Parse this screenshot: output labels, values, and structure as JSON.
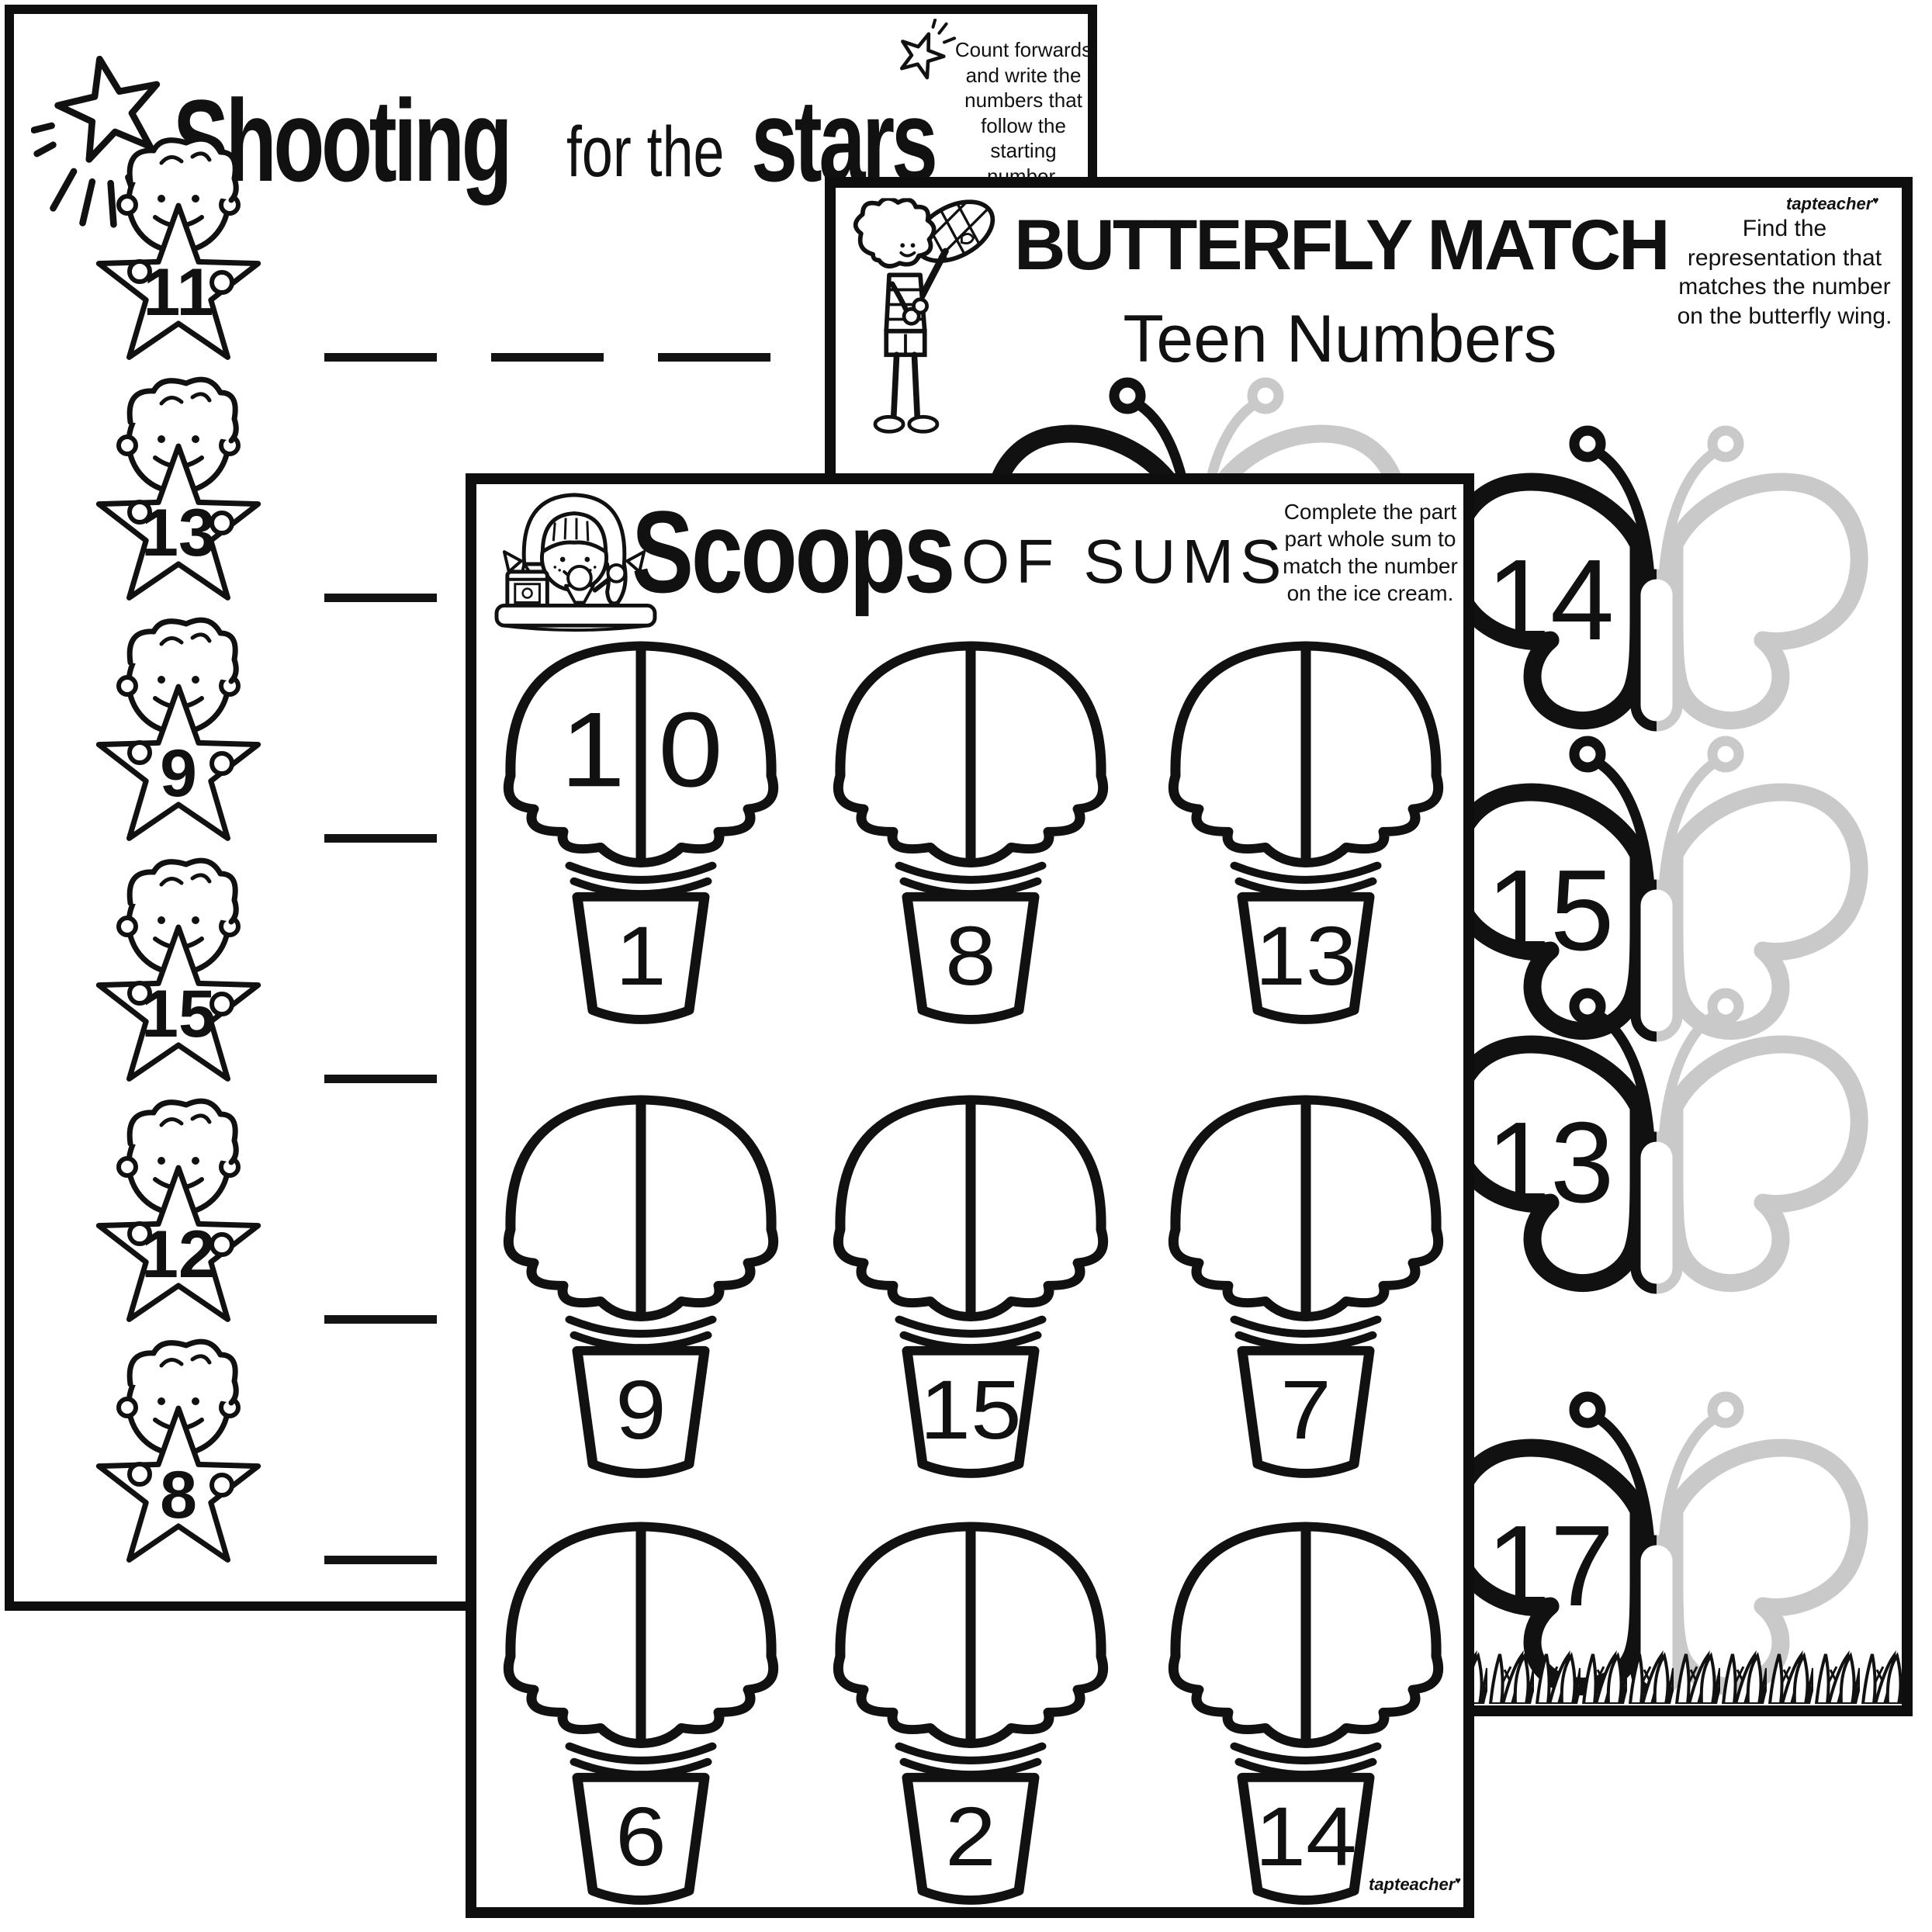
{
  "stars_page": {
    "title": {
      "bold1": "Shooting",
      "script": "for the",
      "bold2": "stars"
    },
    "instructions": "Count forwards and write the numbers that follow the starting number.",
    "rows": [
      {
        "start": "11"
      },
      {
        "start": "13"
      },
      {
        "start": "9"
      },
      {
        "start": "15"
      },
      {
        "start": "12"
      },
      {
        "start": "8"
      }
    ]
  },
  "butterfly_page": {
    "title": "BUTTERFLY MATCH",
    "subtitle": "Teen Numbers",
    "instructions": "Find the representation that matches the number on the butterfly wing.",
    "brand": "tapteacher",
    "brand_mark": "♥",
    "butterflies": [
      {
        "number": "14"
      },
      {
        "number": "15"
      },
      {
        "number": "13"
      },
      {
        "number": "17"
      }
    ]
  },
  "scoops_page": {
    "title": {
      "bold": "Scoops",
      "light": "OF SUMS"
    },
    "instructions": "Complete the part part whole sum to match the number on the ice cream.",
    "brand": "tapteacher",
    "brand_mark": "♥",
    "cones": [
      {
        "part_left": "1",
        "part_right": "0",
        "whole": "1"
      },
      {
        "part_left": "",
        "part_right": "",
        "whole": "8"
      },
      {
        "part_left": "",
        "part_right": "",
        "whole": "13"
      },
      {
        "part_left": "",
        "part_right": "",
        "whole": "9"
      },
      {
        "part_left": "",
        "part_right": "",
        "whole": "15"
      },
      {
        "part_left": "",
        "part_right": "",
        "whole": "7"
      },
      {
        "part_left": "",
        "part_right": "",
        "whole": "6"
      },
      {
        "part_left": "",
        "part_right": "",
        "whole": "2"
      },
      {
        "part_left": "",
        "part_right": "",
        "whole": "14"
      }
    ]
  },
  "colors": {
    "ink": "#111111",
    "muted_wing": "#c9c9c9"
  }
}
